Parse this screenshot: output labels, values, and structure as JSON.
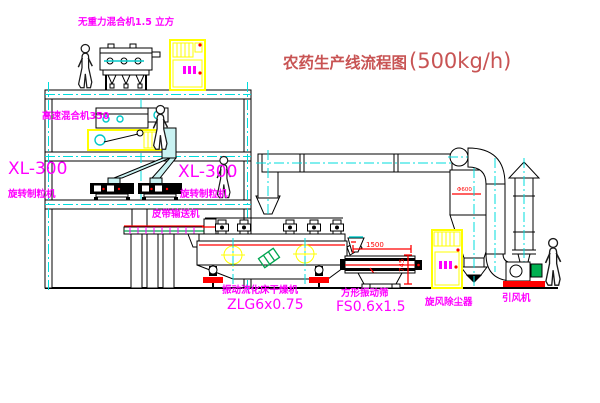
{
  "diagram": {
    "title": "农药生产线流程图",
    "title_capacity": "(500kg/h)"
  },
  "equipment_labels": {
    "gravity_mixer": "无重力混合机1.5 立方",
    "high_speed_mixer": "高速混合机350",
    "granulator_left_model": "XL-300",
    "granulator_left_type": "旋转制粒机",
    "granulator_right_model": "XL-300",
    "granulator_right_type": "旋转制粒机",
    "belt_conveyor": "皮带输送机",
    "fluid_bed_dryer": "振动流化床干燥机",
    "fluid_bed_dryer_model": "ZLG6x0.75",
    "vibrating_screen": "方形振动筛",
    "vibrating_screen_model": "FS0.6x1.5",
    "cyclone_dust_collector": "旋风除尘器",
    "induced_draft_fan": "引风机"
  },
  "dimensions": {
    "screen_length": "1500",
    "screen_height": "745",
    "cyclone_diameter": "Φ600"
  },
  "colors": {
    "label_magenta": "#ff00ff",
    "title_red": "#c85454",
    "dimension_red": "#ff0000",
    "centerline_cyan": "#00dcdc",
    "cabinet_yellow": "#ffff00",
    "accent_green": "#00a550"
  }
}
